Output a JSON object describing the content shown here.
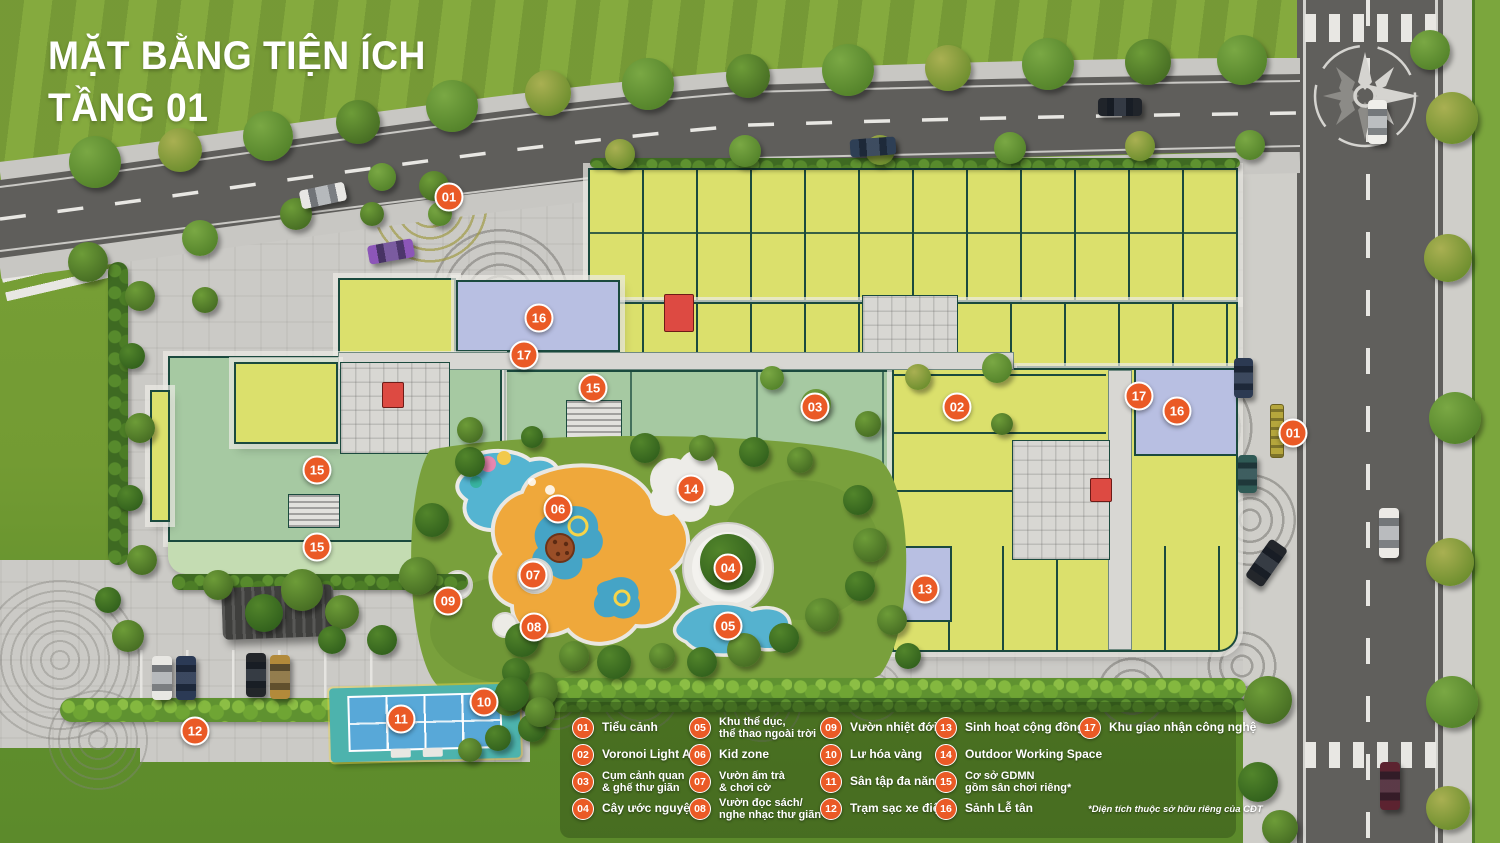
{
  "title": {
    "line1": "MẶT BẰNG TIỆN ÍCH",
    "line2": "TẦNG 01"
  },
  "legend": {
    "columns": [
      {
        "items": [
          {
            "num": "01",
            "label": "Tiểu cảnh"
          },
          {
            "num": "02",
            "label": "Voronoi Light Art"
          },
          {
            "num": "03",
            "label": "Cụm cảnh quan\n& ghế thư giãn"
          },
          {
            "num": "04",
            "label": "Cây ước nguyện"
          }
        ]
      },
      {
        "items": [
          {
            "num": "05",
            "label": "Khu thể dục,\nthể thao ngoài trời"
          },
          {
            "num": "06",
            "label": "Kid zone"
          },
          {
            "num": "07",
            "label": "Vườn ấm trà\n& chơi cờ"
          },
          {
            "num": "08",
            "label": "Vườn đọc sách/\nnghe nhạc thư giãn"
          }
        ]
      },
      {
        "items": [
          {
            "num": "09",
            "label": "Vườn nhiệt đới"
          },
          {
            "num": "10",
            "label": "Lư hóa vàng"
          },
          {
            "num": "11",
            "label": "Sân tập đa năng"
          },
          {
            "num": "12",
            "label": "Trạm sạc xe điện*"
          }
        ]
      },
      {
        "items": [
          {
            "num": "13",
            "label": "Sinh hoạt cộng đồng"
          },
          {
            "num": "14",
            "label": "Outdoor Working Space"
          },
          {
            "num": "15",
            "label": "Cơ sở GDMN\ngồm sân chơi riêng*"
          },
          {
            "num": "16",
            "label": "Sảnh Lễ tân"
          }
        ]
      },
      {
        "items": [
          {
            "num": "17",
            "label": "Khu giao nhận công nghệ"
          }
        ]
      }
    ],
    "footnote": "*Diện tích thuộc sở hữu riêng của CĐT"
  },
  "plan_markers": [
    {
      "num": "01",
      "x": 449,
      "y": 197
    },
    {
      "num": "16",
      "x": 539,
      "y": 318
    },
    {
      "num": "17",
      "x": 524,
      "y": 355
    },
    {
      "num": "15",
      "x": 593,
      "y": 388
    },
    {
      "num": "15",
      "x": 317,
      "y": 470
    },
    {
      "num": "15",
      "x": 317,
      "y": 547
    },
    {
      "num": "03",
      "x": 815,
      "y": 407
    },
    {
      "num": "02",
      "x": 957,
      "y": 407
    },
    {
      "num": "17",
      "x": 1139,
      "y": 396
    },
    {
      "num": "16",
      "x": 1177,
      "y": 411
    },
    {
      "num": "01",
      "x": 1293,
      "y": 433
    },
    {
      "num": "14",
      "x": 691,
      "y": 489
    },
    {
      "num": "06",
      "x": 558,
      "y": 509
    },
    {
      "num": "04",
      "x": 728,
      "y": 568
    },
    {
      "num": "07",
      "x": 533,
      "y": 575
    },
    {
      "num": "09",
      "x": 448,
      "y": 601
    },
    {
      "num": "08",
      "x": 534,
      "y": 627
    },
    {
      "num": "05",
      "x": 728,
      "y": 626
    },
    {
      "num": "13",
      "x": 925,
      "y": 589
    },
    {
      "num": "10",
      "x": 484,
      "y": 702
    },
    {
      "num": "11",
      "x": 401,
      "y": 719
    },
    {
      "num": "12",
      "x": 195,
      "y": 731
    }
  ],
  "colors": {
    "marker_orange": "#EA5A26",
    "unit_yellow": "#DBE06C",
    "kindergarten_mint": "#A6C9A2",
    "lobby_lavender": "#B8BFE2",
    "wall_green": "#1B4A3E",
    "elevator_red": "#DD4A42",
    "pool_blue": "#54B4D1",
    "kidzone_sand": "#EFA83B",
    "court_blue": "#58A8D8",
    "title_white": "#FFFFFF"
  }
}
